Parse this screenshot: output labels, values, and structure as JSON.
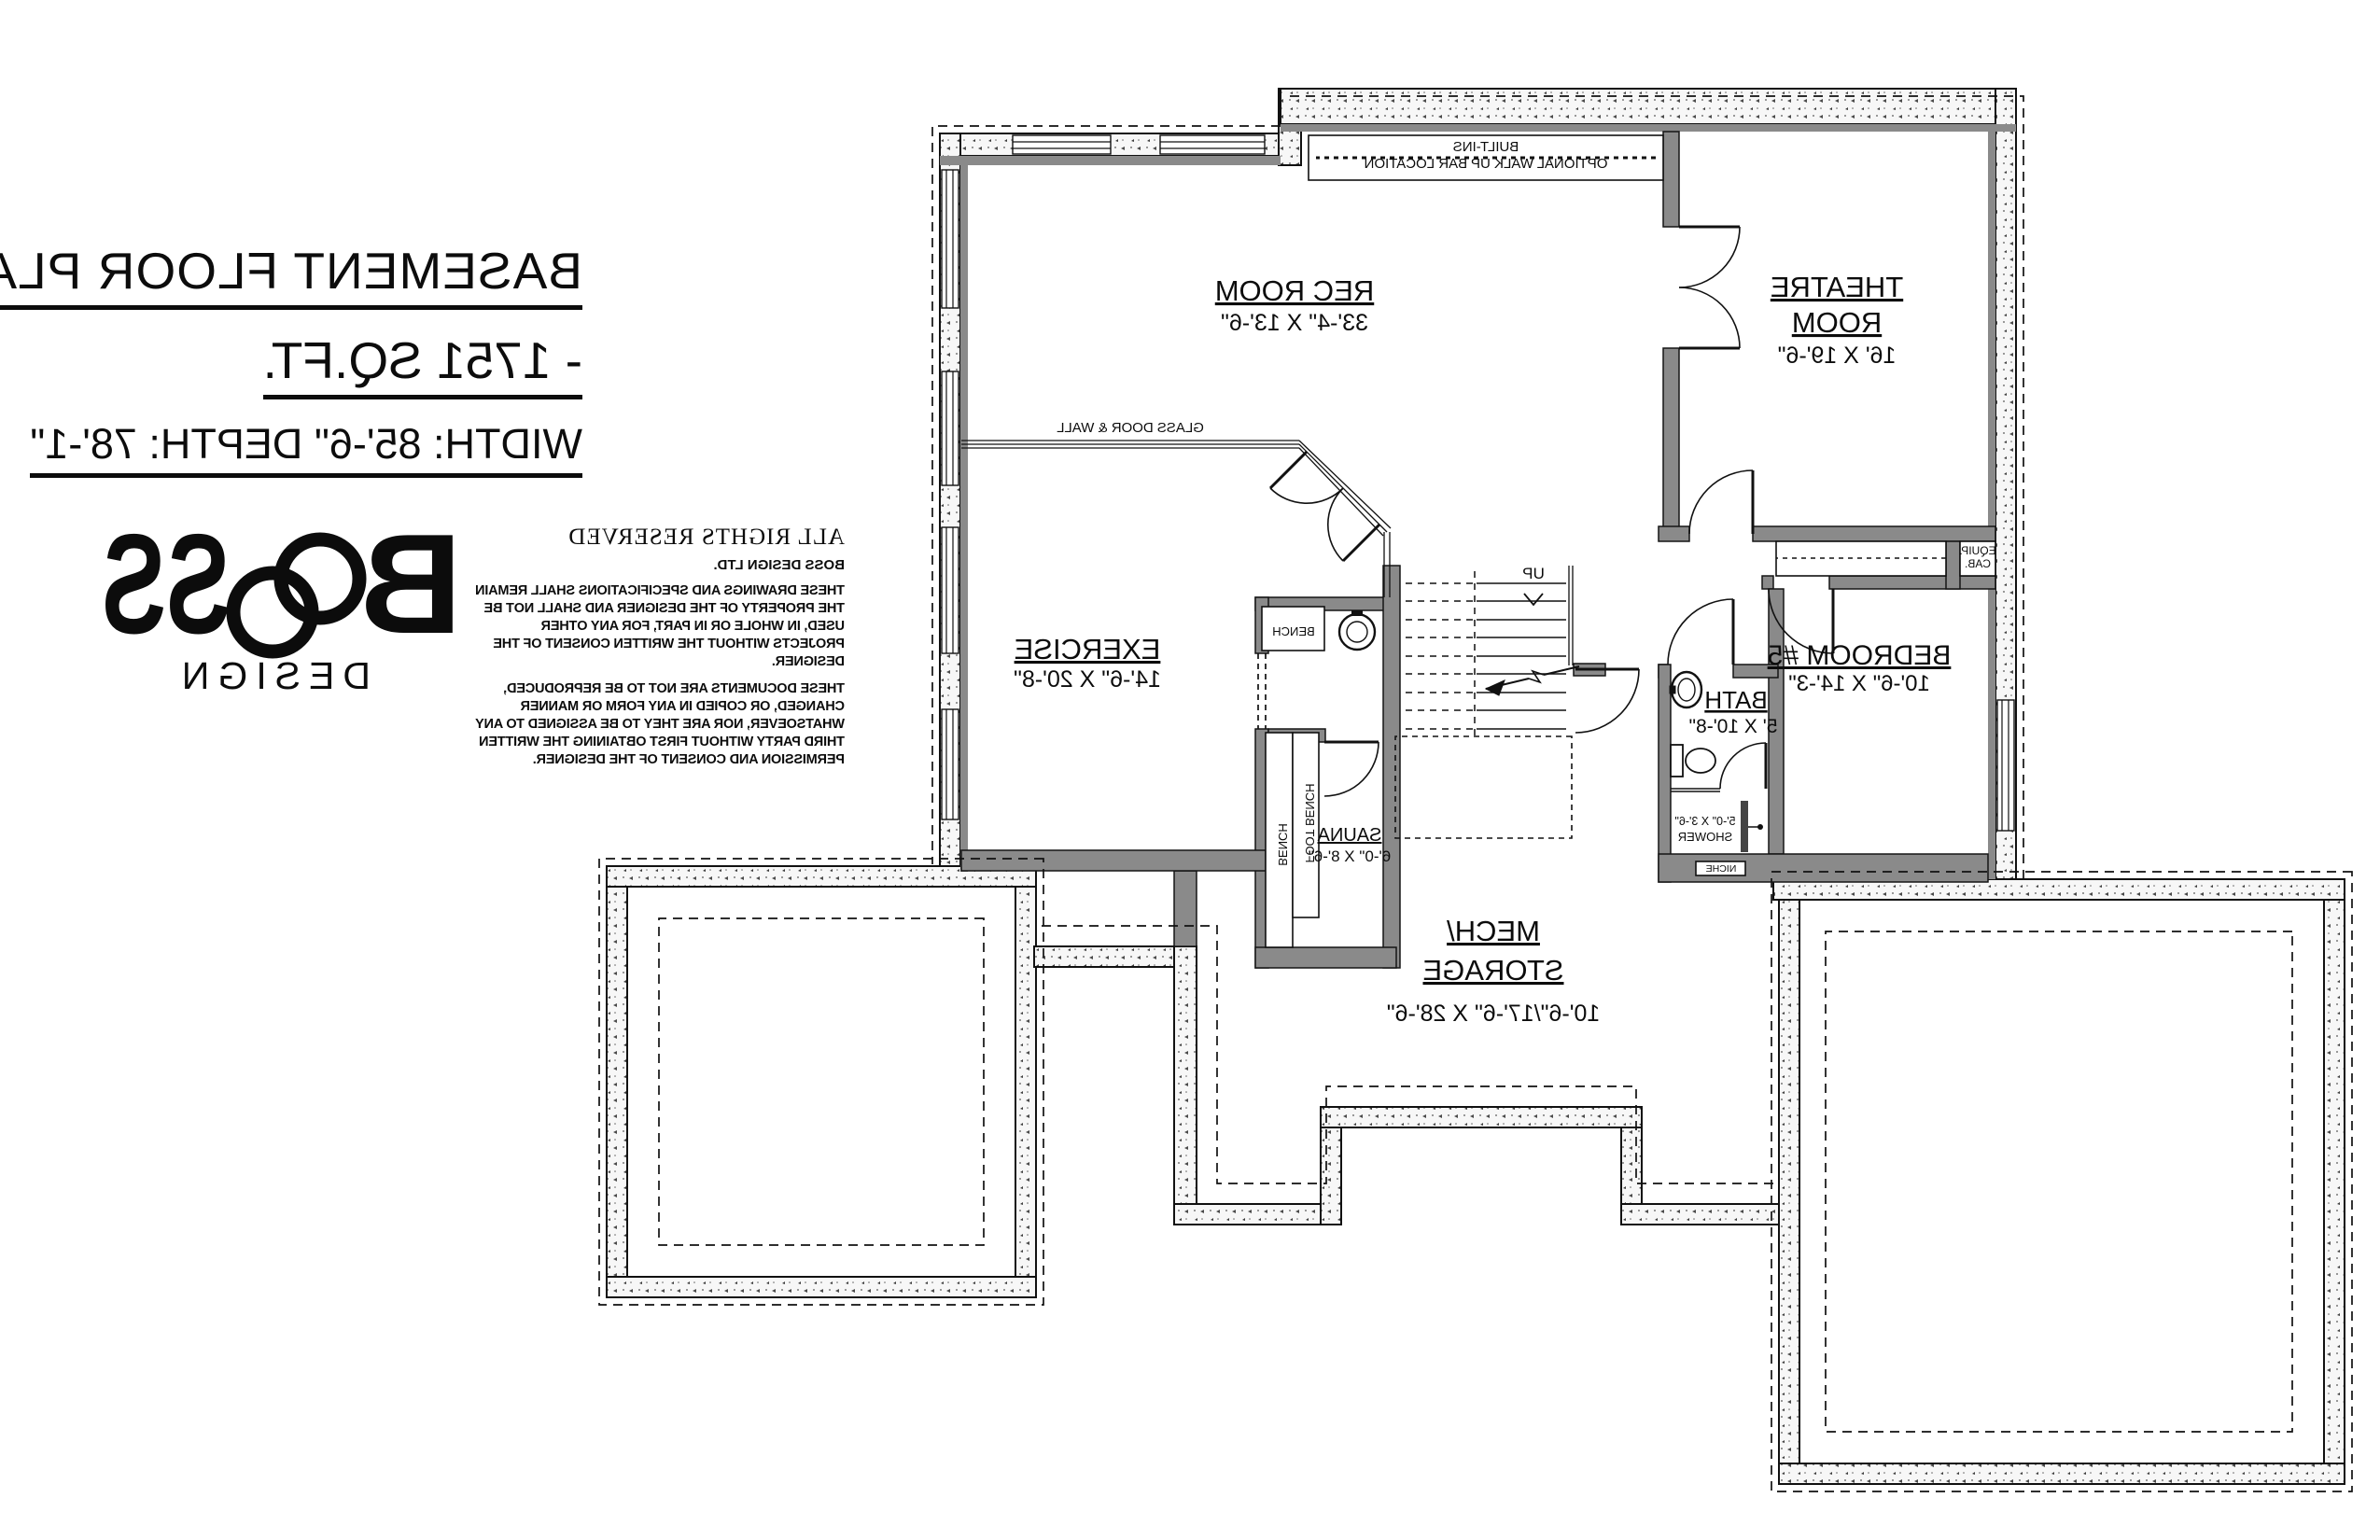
{
  "title_block": {
    "line1": "BASEMENT FLOOR PLAN",
    "line2": "- 1751 SQ.FT.",
    "line3": "WIDTH: 85'-6\" DEPTH: 78'-1\""
  },
  "logo": {
    "b": "B",
    "ss": "SS",
    "sub": "DESIGN"
  },
  "copyright": {
    "heading": "ALL RIGHTS RESERVED",
    "company": "BOSS DESIGN LTD.",
    "para1": "THESE DRAWINGS AND SPECIFICATIONS SHALL REMAIN THE PROPERTY OF THE DESIGNER AND SHALL NOT BE USED, IN WHOLE OR IN PART, FOR ANY OTHER PROJECTS WITHOUT THE WRITTEN CONSENT OF THE DESIGNER.",
    "para2": "THESE DOCUMENTS ARE NOT TO BE REPRODUCED, CHANGED, OR COPIED IN ANY FORM OR MANNER WHATSOEVER, NOR ARE THEY TO BE ASSIGNED TO ANY THIRD PARTY WITHOUT FIRST OBTAINING THE WRITTEN PERMISSION AND CONSENT OF THE DESIGNER."
  },
  "rooms": {
    "rec": {
      "name": "REC ROOM",
      "dims": "33'-4\" X 13'-6\""
    },
    "theatre": {
      "name1": "THEATRE",
      "name2": "ROOM",
      "dims": "16' X 19'-6\""
    },
    "exercise": {
      "name": "EXERCISE",
      "dims": "14'-6\" X 20'-8\""
    },
    "bedroom5": {
      "name": "BEDROOM #5",
      "dims": "10'-6\" X 14'-3\""
    },
    "bath": {
      "name": "BATH",
      "dims": "5' X 10'-8\""
    },
    "mech": {
      "name1": "MECH/",
      "name2": "STORAGE",
      "dims": "10'-6\"/17'-6\" X 28'-6\""
    },
    "sauna": {
      "name": "SAUNA",
      "dims": "6'-0\" X 8'-6\""
    }
  },
  "labels": {
    "built_ins_1": "BUILT-INS",
    "built_ins_2": "OPTIONAL WALK UP BAR LOCATION",
    "glass_door_wall": "GLASS DOOR & WALL",
    "up": "UP",
    "bench_vestibule": "BENCH",
    "bench_sauna": "BENCH",
    "foot_bench": "FOOT BENCH",
    "equip_1": "EQUIP.",
    "equip_2": "CAB.",
    "niche": "NICHE",
    "shower_dims": "5'-0\" X 3'-6\"",
    "shower": "SHOWER"
  },
  "colors": {
    "wall_gray": "#8a8a8a",
    "line": "#111111"
  }
}
